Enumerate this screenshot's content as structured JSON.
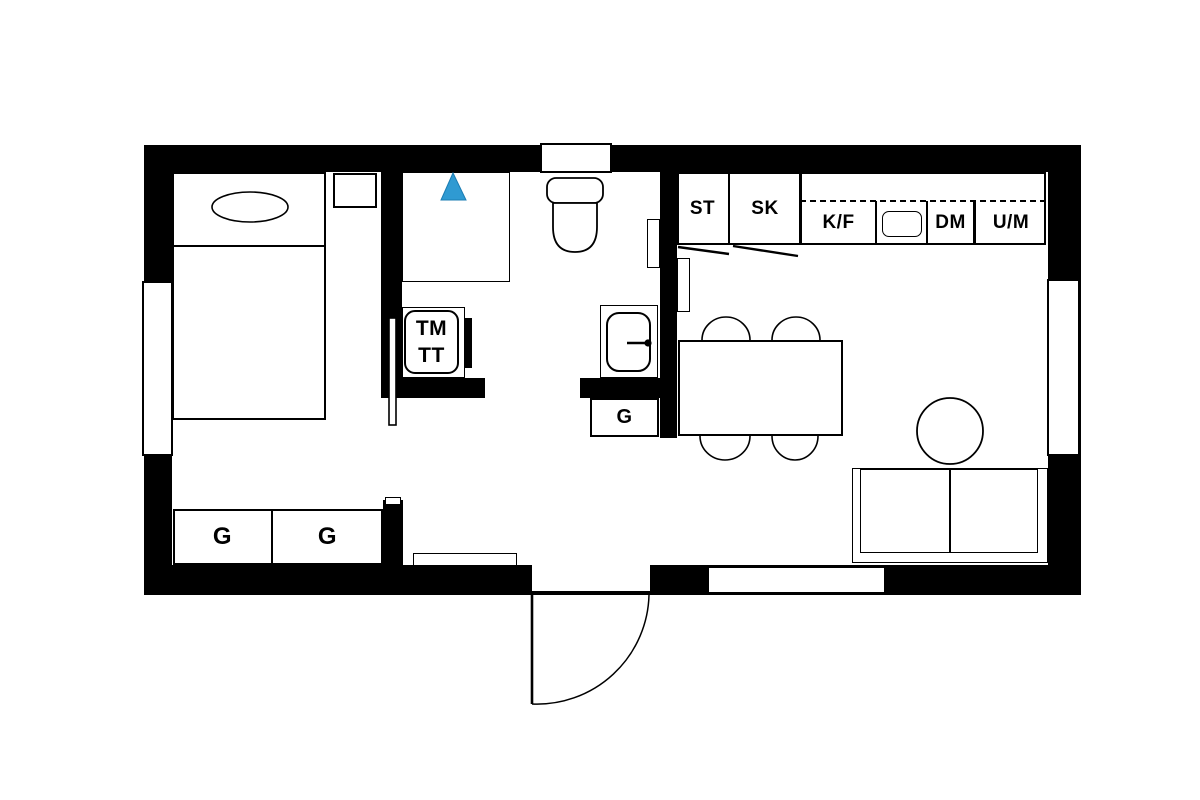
{
  "floorplan": {
    "background": "#ffffff",
    "wall_color": "#000000",
    "line_color": "#000000",
    "shower_marker": {
      "shape": "triangle-up",
      "fill": "#2f9ad2",
      "edge": "#1b7db3"
    },
    "labels": {
      "bedroom_closet_1": "G",
      "bedroom_closet_2": "G",
      "hall_closet": "G",
      "washer_line1": "TM",
      "washer_line2": "TT",
      "kitchen_units": [
        {
          "key": "tall-cabinet",
          "label": "ST"
        },
        {
          "key": "pantry-cabinet",
          "label": "SK"
        },
        {
          "key": "fridge-freezer",
          "label": "K/F"
        },
        {
          "key": "dishwasher",
          "label": "DM"
        },
        {
          "key": "oven-microwave",
          "label": "U/M"
        }
      ]
    }
  }
}
